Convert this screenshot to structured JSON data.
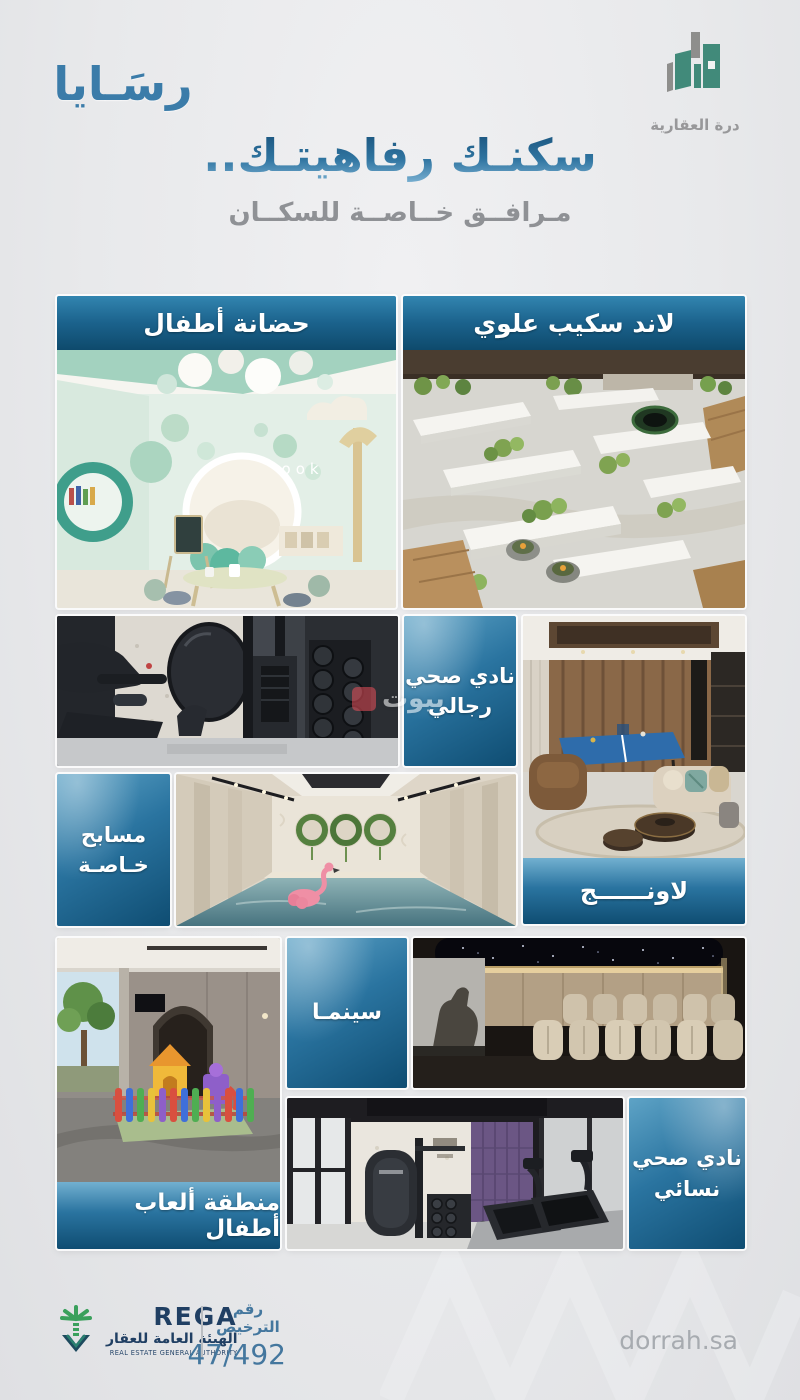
{
  "brand": {
    "rasaya_text": "رسَـايا",
    "dorrah_caption": "درة العقارية"
  },
  "hero": {
    "title": "سكنـك رفاهيتـك..",
    "subtitle": "مـرافــق خــاصــة للسكــان"
  },
  "amenities": {
    "nursery": {
      "label": "حضانة أطفال"
    },
    "landscape": {
      "label": "لاند سكيب علوي"
    },
    "mens_gym": {
      "line1": "نادي صحي",
      "line2": "رجالي"
    },
    "lounge": {
      "label": "لاونــــــج"
    },
    "private_pools": {
      "line1": "مسابح",
      "line2": "خـاصـة"
    },
    "cinema": {
      "label": "سينمـا"
    },
    "kids_play_area": {
      "label": "منطقة ألعاب أطفال"
    },
    "womens_gym": {
      "line1": "نادي صحي",
      "line2": "نسائي"
    }
  },
  "photos": {
    "nursery_wall_text": "book"
  },
  "watermark": {
    "text": "بيوت"
  },
  "footer": {
    "rega_name": "REGA",
    "rega_name_ar": "الهيئة العامة للعقار",
    "rega_tagline": "REAL ESTATE GENERAL AUTHORITY",
    "license_label": "رقم الترخيص",
    "license_number": "47/492",
    "website": "dorrah.sa"
  },
  "colors": {
    "page_bg": "#e8e9eb",
    "banner_top": "#3285b0",
    "banner_bottom": "#0e4a6c",
    "heading_blue": "#2f74a0",
    "subtitle_gray": "#8f9195",
    "dorrah_teal": "#418a7a",
    "rega_navy": "#203f63",
    "rega_green": "#3aa05c",
    "license_blue": "#44779e",
    "website_gray": "#a7abb0"
  }
}
